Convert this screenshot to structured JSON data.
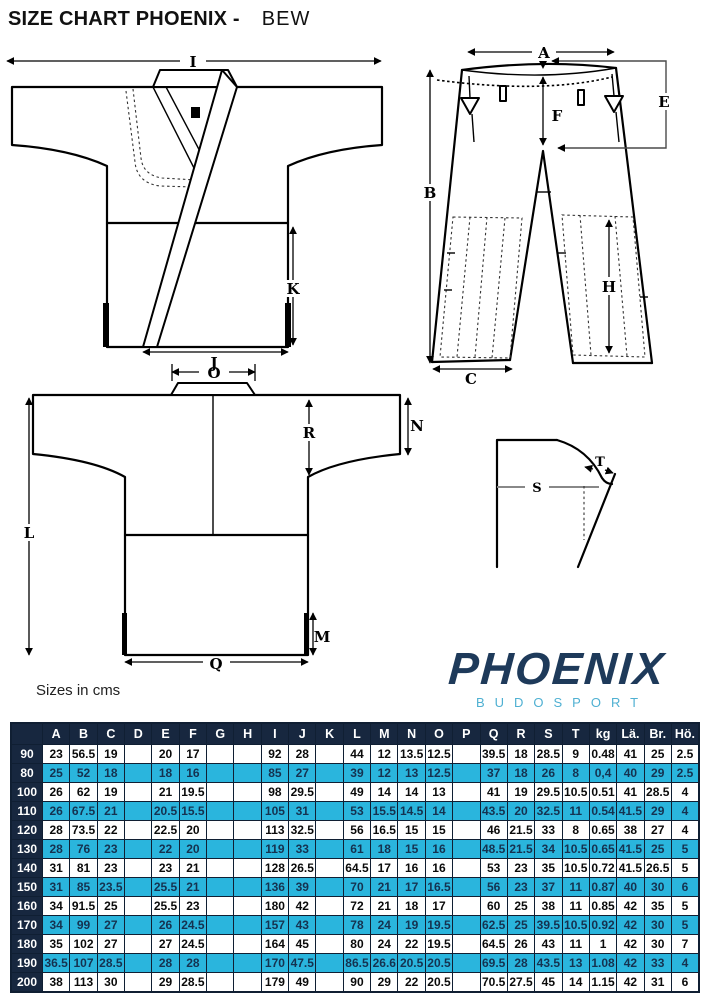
{
  "title": {
    "main": "SIZE CHART PHOENIX -",
    "variant": "BEW"
  },
  "note": "Sizes in cms",
  "logo": {
    "brand": "PHOENIX",
    "sub": "BUDOSPORT"
  },
  "colors": {
    "header_bg": "#17273f",
    "row_cyan": "#2ab5dd",
    "row_text_cyan": "#153250",
    "border": "#101f33",
    "logo_navy": "#1e3a5a",
    "logo_cyan": "#4fb0d2"
  },
  "diagram": {
    "labels": {
      "I": "I",
      "K": "K",
      "J": "J",
      "A": "A",
      "B": "B",
      "C": "C",
      "E": "E",
      "F": "F",
      "H": "H",
      "O": "O",
      "N": "N",
      "R": "R",
      "L": "L",
      "M": "M",
      "Q": "Q",
      "S": "S",
      "T": "T"
    }
  },
  "table": {
    "corner": "",
    "columns": [
      "A",
      "B",
      "C",
      "D",
      "E",
      "F",
      "G",
      "H",
      "I",
      "J",
      "K",
      "L",
      "M",
      "N",
      "O",
      "P",
      "Q",
      "R",
      "S",
      "T",
      "kg",
      "Lä.",
      "Br.",
      "Hö."
    ],
    "rows": [
      {
        "size": "90",
        "highlight": false,
        "values": [
          "23",
          "56.5",
          "19",
          "",
          "20",
          "17",
          "",
          "",
          "92",
          "28",
          "",
          "44",
          "12",
          "13.5",
          "12.5",
          "",
          "39.5",
          "18",
          "28.5",
          "9",
          "0.48",
          "41",
          "25",
          "2.5"
        ]
      },
      {
        "size": "80",
        "highlight": true,
        "values": [
          "25",
          "52",
          "18",
          "",
          "18",
          "16",
          "",
          "",
          "85",
          "27",
          "",
          "39",
          "12",
          "13",
          "12.5",
          "",
          "37",
          "18",
          "26",
          "8",
          "0,4",
          "40",
          "29",
          "2.5"
        ]
      },
      {
        "size": "100",
        "highlight": false,
        "values": [
          "26",
          "62",
          "19",
          "",
          "21",
          "19.5",
          "",
          "",
          "98",
          "29.5",
          "",
          "49",
          "14",
          "14",
          "13",
          "",
          "41",
          "19",
          "29.5",
          "10.5",
          "0.51",
          "41",
          "28.5",
          "4"
        ]
      },
      {
        "size": "110",
        "highlight": true,
        "values": [
          "26",
          "67.5",
          "21",
          "",
          "20.5",
          "15.5",
          "",
          "",
          "105",
          "31",
          "",
          "53",
          "15.5",
          "14.5",
          "14",
          "",
          "43.5",
          "20",
          "32.5",
          "11",
          "0.54",
          "41.5",
          "29",
          "4"
        ]
      },
      {
        "size": "120",
        "highlight": false,
        "values": [
          "28",
          "73.5",
          "22",
          "",
          "22.5",
          "20",
          "",
          "",
          "113",
          "32.5",
          "",
          "56",
          "16.5",
          "15",
          "15",
          "",
          "46",
          "21.5",
          "33",
          "8",
          "0.65",
          "38",
          "27",
          "4"
        ]
      },
      {
        "size": "130",
        "highlight": true,
        "values": [
          "28",
          "76",
          "23",
          "",
          "22",
          "20",
          "",
          "",
          "119",
          "33",
          "",
          "61",
          "18",
          "15",
          "16",
          "",
          "48.5",
          "21.5",
          "34",
          "10.5",
          "0.65",
          "41.5",
          "25",
          "5"
        ]
      },
      {
        "size": "140",
        "highlight": false,
        "values": [
          "31",
          "81",
          "23",
          "",
          "23",
          "21",
          "",
          "",
          "128",
          "26.5",
          "",
          "64.5",
          "17",
          "16",
          "16",
          "",
          "53",
          "23",
          "35",
          "10.5",
          "0.72",
          "41.5",
          "26.5",
          "5"
        ]
      },
      {
        "size": "150",
        "highlight": true,
        "values": [
          "31",
          "85",
          "23.5",
          "",
          "25.5",
          "21",
          "",
          "",
          "136",
          "39",
          "",
          "70",
          "21",
          "17",
          "16.5",
          "",
          "56",
          "23",
          "37",
          "11",
          "0.87",
          "40",
          "30",
          "6"
        ]
      },
      {
        "size": "160",
        "highlight": false,
        "values": [
          "34",
          "91.5",
          "25",
          "",
          "25.5",
          "23",
          "",
          "",
          "180",
          "42",
          "",
          "72",
          "21",
          "18",
          "17",
          "",
          "60",
          "25",
          "38",
          "11",
          "0.85",
          "42",
          "35",
          "5"
        ]
      },
      {
        "size": "170",
        "highlight": true,
        "values": [
          "34",
          "99",
          "27",
          "",
          "26",
          "24.5",
          "",
          "",
          "157",
          "43",
          "",
          "78",
          "24",
          "19",
          "19.5",
          "",
          "62.5",
          "25",
          "39.5",
          "10.5",
          "0.92",
          "42",
          "30",
          "5"
        ]
      },
      {
        "size": "180",
        "highlight": false,
        "values": [
          "35",
          "102",
          "27",
          "",
          "27",
          "24.5",
          "",
          "",
          "164",
          "45",
          "",
          "80",
          "24",
          "22",
          "19.5",
          "",
          "64.5",
          "26",
          "43",
          "11",
          "1",
          "42",
          "30",
          "7"
        ]
      },
      {
        "size": "190",
        "highlight": true,
        "values": [
          "36.5",
          "107",
          "28.5",
          "",
          "28",
          "28",
          "",
          "",
          "170",
          "47.5",
          "",
          "86.5",
          "26.6",
          "20.5",
          "20.5",
          "",
          "69.5",
          "28",
          "43.5",
          "13",
          "1.08",
          "42",
          "33",
          "4"
        ]
      },
      {
        "size": "200",
        "highlight": false,
        "values": [
          "38",
          "113",
          "30",
          "",
          "29",
          "28.5",
          "",
          "",
          "179",
          "49",
          "",
          "90",
          "29",
          "22",
          "20.5",
          "",
          "70.5",
          "27.5",
          "45",
          "14",
          "1.15",
          "42",
          "31",
          "6"
        ]
      }
    ]
  }
}
